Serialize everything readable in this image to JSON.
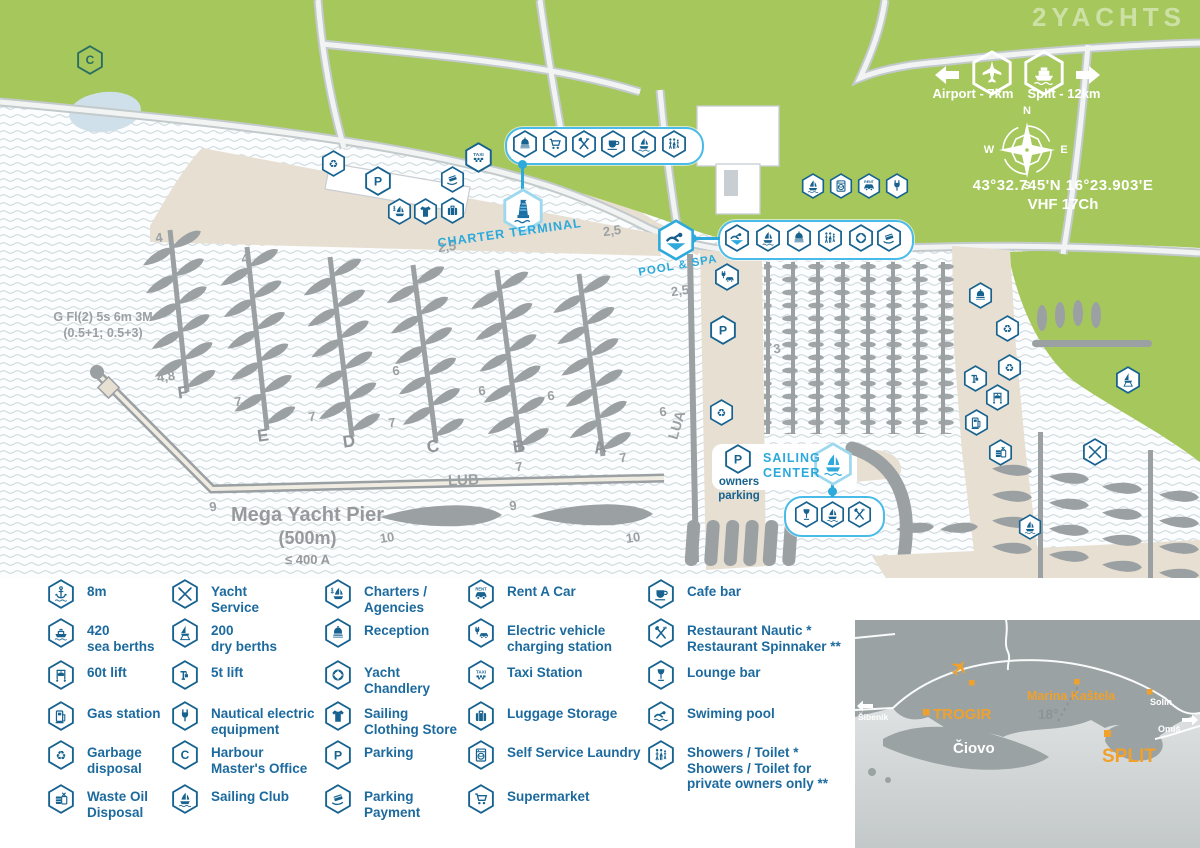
{
  "watermark": "2YACHTS",
  "colors": {
    "icon_blue": "#17628f",
    "cyan": "#2ea9dc",
    "green": "#a5c75c",
    "beige": "#e7dfd2",
    "gray": "#9ba0a3",
    "orange": "#f0a12c",
    "teal": "#2a6d62"
  },
  "icon_labels": {
    "taxi": "TAXI",
    "rent": "RENT"
  },
  "top_right": {
    "airport_label": "Airport - 7km",
    "split_label": "Split - 12km",
    "coords": "43°32.745'N   16°23.903'E",
    "vhf": "VHF 17Ch"
  },
  "compass": {
    "n": "N",
    "e": "E",
    "s": "S",
    "w": "W"
  },
  "map": {
    "labels": {
      "light1": "G Fl(2) 5s 6m 3M",
      "light2": "(0.5+1; 0.5+3)",
      "charter_terminal": "CHARTER TERMINAL",
      "pool_spa": "POOL & SPA",
      "sailing_center_1": "SAILING",
      "sailing_center_2": "CENTER",
      "owners_1": "owners",
      "owners_2": "parking",
      "mega_1": "Mega Yacht Pier",
      "mega_2": "(500m)",
      "mega_3": "≤ 400 A",
      "lub": "LUB",
      "lua": "LUA"
    },
    "pier_letters": [
      {
        "t": "F",
        "x": 183,
        "y": 393
      },
      {
        "t": "E",
        "x": 263,
        "y": 436
      },
      {
        "t": "D",
        "x": 349,
        "y": 442
      },
      {
        "t": "C",
        "x": 433,
        "y": 447
      },
      {
        "t": "B",
        "x": 519,
        "y": 447
      },
      {
        "t": "A",
        "x": 600,
        "y": 448
      }
    ],
    "depths": [
      {
        "t": "4",
        "x": 159,
        "y": 238
      },
      {
        "t": "4",
        "x": 245,
        "y": 259
      },
      {
        "t": "2,5",
        "x": 447,
        "y": 247
      },
      {
        "t": "2,5",
        "x": 612,
        "y": 231
      },
      {
        "t": "4,8",
        "x": 166,
        "y": 377
      },
      {
        "t": "7",
        "x": 238,
        "y": 402
      },
      {
        "t": "7",
        "x": 312,
        "y": 417
      },
      {
        "t": "7",
        "x": 392,
        "y": 423
      },
      {
        "t": "6",
        "x": 396,
        "y": 371
      },
      {
        "t": "6",
        "x": 482,
        "y": 391
      },
      {
        "t": "6",
        "x": 551,
        "y": 396
      },
      {
        "t": "7",
        "x": 519,
        "y": 467
      },
      {
        "t": "7",
        "x": 623,
        "y": 458
      },
      {
        "t": "9",
        "x": 213,
        "y": 507
      },
      {
        "t": "9",
        "x": 513,
        "y": 506
      },
      {
        "t": "10",
        "x": 387,
        "y": 538
      },
      {
        "t": "10",
        "x": 633,
        "y": 538
      },
      {
        "t": "2,5",
        "x": 680,
        "y": 291
      },
      {
        "t": "3",
        "x": 777,
        "y": 349
      },
      {
        "t": "6",
        "x": 663,
        "y": 412
      }
    ],
    "badges": [
      {
        "icon": "letter-c",
        "x": 90,
        "y": 60,
        "s": 30,
        "v": "teal"
      },
      {
        "icon": "recycle",
        "x": 333,
        "y": 163,
        "s": 27
      },
      {
        "icon": "letter-p",
        "x": 378,
        "y": 181,
        "s": 30
      },
      {
        "icon": "card-hand",
        "x": 452,
        "y": 179,
        "s": 27
      },
      {
        "icon": "taxi",
        "x": 478,
        "y": 157,
        "s": 31
      },
      {
        "icon": "sailboat-anchor",
        "x": 399,
        "y": 211,
        "s": 27
      },
      {
        "icon": "tshirt",
        "x": 425,
        "y": 211,
        "s": 27
      },
      {
        "icon": "suitcase",
        "x": 452,
        "y": 210,
        "s": 27
      },
      {
        "icon": "tower",
        "x": 523,
        "y": 211,
        "s": 46,
        "v": "tower"
      },
      {
        "icon": "bell",
        "x": 525,
        "y": 144,
        "s": 28
      },
      {
        "icon": "cart",
        "x": 555,
        "y": 144,
        "s": 28
      },
      {
        "icon": "fork-spoon",
        "x": 584,
        "y": 144,
        "s": 28
      },
      {
        "icon": "coffee-cup",
        "x": 613,
        "y": 144,
        "s": 28
      },
      {
        "icon": "sailboat",
        "x": 644,
        "y": 144,
        "s": 28
      },
      {
        "icon": "people",
        "x": 674,
        "y": 144,
        "s": 28
      },
      {
        "icon": "swimmer-pool",
        "x": 676,
        "y": 240,
        "s": 42,
        "v": "cyan"
      },
      {
        "icon": "swimmer-pool",
        "x": 737,
        "y": 238,
        "s": 28
      },
      {
        "icon": "sailboat",
        "x": 768,
        "y": 238,
        "s": 28
      },
      {
        "icon": "bell",
        "x": 799,
        "y": 238,
        "s": 28
      },
      {
        "icon": "people",
        "x": 830,
        "y": 238,
        "s": 28
      },
      {
        "icon": "life-ring",
        "x": 861,
        "y": 238,
        "s": 28
      },
      {
        "icon": "card-hand",
        "x": 889,
        "y": 238,
        "s": 28
      },
      {
        "icon": "sailboat",
        "x": 813,
        "y": 186,
        "s": 26
      },
      {
        "icon": "washing-machine",
        "x": 841,
        "y": 186,
        "s": 26
      },
      {
        "icon": "car-rent",
        "x": 869,
        "y": 186,
        "s": 26
      },
      {
        "icon": "plug",
        "x": 897,
        "y": 186,
        "s": 26
      },
      {
        "icon": "ev-charging",
        "x": 727,
        "y": 277,
        "s": 28
      },
      {
        "icon": "letter-p",
        "x": 723,
        "y": 330,
        "s": 30
      },
      {
        "icon": "recycle",
        "x": 721,
        "y": 412,
        "s": 27
      },
      {
        "icon": "letter-p",
        "x": 738,
        "y": 459,
        "s": 30
      },
      {
        "icon": "sailboat",
        "x": 833,
        "y": 464,
        "s": 44,
        "v": "cyan2"
      },
      {
        "icon": "wine-glass",
        "x": 806,
        "y": 514,
        "s": 27
      },
      {
        "icon": "sailboat",
        "x": 832,
        "y": 514,
        "s": 27
      },
      {
        "icon": "fork-spoon",
        "x": 859,
        "y": 514,
        "s": 27
      },
      {
        "icon": "bell",
        "x": 980,
        "y": 295,
        "s": 27
      },
      {
        "icon": "recycle",
        "x": 1007,
        "y": 328,
        "s": 27
      },
      {
        "icon": "recycle",
        "x": 1009,
        "y": 367,
        "s": 27
      },
      {
        "icon": "crane-5t",
        "x": 975,
        "y": 378,
        "s": 27
      },
      {
        "icon": "crane-60t",
        "x": 997,
        "y": 397,
        "s": 27
      },
      {
        "icon": "gas-pump",
        "x": 976,
        "y": 422,
        "s": 27
      },
      {
        "icon": "waste-oil",
        "x": 1000,
        "y": 452,
        "s": 27
      },
      {
        "icon": "tools",
        "x": 1095,
        "y": 452,
        "s": 28
      },
      {
        "icon": "boat-stand",
        "x": 1128,
        "y": 380,
        "s": 28
      },
      {
        "icon": "sailboat",
        "x": 1030,
        "y": 527,
        "s": 26
      },
      {
        "icon": "plane",
        "x": 992,
        "y": 73,
        "s": 46,
        "v": "white"
      },
      {
        "icon": "ferry",
        "x": 1044,
        "y": 73,
        "s": 46,
        "v": "white"
      }
    ]
  },
  "legend": {
    "columns": [
      {
        "items": [
          {
            "icon": "anchor-depth",
            "lines": [
              "8m"
            ]
          },
          {
            "icon": "ship",
            "lines": [
              "420",
              "sea berths"
            ]
          },
          {
            "icon": "crane-60t",
            "lines": [
              "60t lift"
            ]
          },
          {
            "icon": "gas-pump",
            "lines": [
              "Gas station"
            ]
          },
          {
            "icon": "recycle",
            "lines": [
              "Garbage",
              "disposal"
            ]
          },
          {
            "icon": "waste-oil",
            "lines": [
              "Waste Oil",
              "Disposal"
            ]
          }
        ]
      },
      {
        "items": [
          {
            "icon": "tools",
            "lines": [
              "Yacht",
              "Service"
            ]
          },
          {
            "icon": "boat-stand",
            "lines": [
              "200",
              "dry berths"
            ]
          },
          {
            "icon": "crane-5t",
            "lines": [
              "5t lift"
            ]
          },
          {
            "icon": "plug",
            "lines": [
              "Nautical electric",
              "equipment"
            ]
          },
          {
            "icon": "letter-c",
            "lines": [
              "Harbour",
              "Master's Office"
            ]
          },
          {
            "icon": "sailboat",
            "lines": [
              "Sailing Club"
            ]
          }
        ]
      },
      {
        "items": [
          {
            "icon": "sailboat-anchor",
            "lines": [
              "Charters /",
              "Agencies"
            ]
          },
          {
            "icon": "bell",
            "lines": [
              "Reception"
            ]
          },
          {
            "icon": "life-ring",
            "lines": [
              "Yacht",
              "Chandlery"
            ]
          },
          {
            "icon": "tshirt",
            "lines": [
              "Sailing",
              "Clothing Store"
            ]
          },
          {
            "icon": "letter-p",
            "lines": [
              "Parking"
            ]
          },
          {
            "icon": "card-hand",
            "lines": [
              "Parking",
              "Payment"
            ]
          }
        ]
      },
      {
        "items": [
          {
            "icon": "car-rent",
            "lines": [
              "Rent A Car"
            ]
          },
          {
            "icon": "ev-charging",
            "lines": [
              "Electric vehicle",
              "charging station"
            ]
          },
          {
            "icon": "taxi",
            "lines": [
              "Taxi Station"
            ]
          },
          {
            "icon": "suitcase",
            "lines": [
              "Luggage Storage"
            ]
          },
          {
            "icon": "washing-machine",
            "lines": [
              "Self Service Laundry"
            ]
          },
          {
            "icon": "cart",
            "lines": [
              "Supermarket"
            ]
          }
        ]
      },
      {
        "items": [
          {
            "icon": "coffee-cup",
            "lines": [
              "Cafe bar"
            ]
          },
          {
            "icon": "fork-spoon",
            "lines": [
              "Restaurant Nautic *",
              "Restaurant Spinnaker **"
            ]
          },
          {
            "icon": "wine-glass",
            "lines": [
              "Lounge bar"
            ]
          },
          {
            "icon": "swimmer",
            "lines": [
              "Swiming pool"
            ]
          },
          {
            "icon": "people",
            "lines": [
              "Showers / Toilet *",
              "Showers / Toilet for",
              "private owners only **"
            ]
          }
        ]
      }
    ]
  },
  "inset": {
    "sibenik": "Šibenik",
    "trogir": "TROGIR",
    "ciovo": "Čiovo",
    "marina": "Marina Kaštela",
    "deg": "18°",
    "solin": "Solin",
    "omis": "Omiš",
    "split": "SPLIT"
  }
}
